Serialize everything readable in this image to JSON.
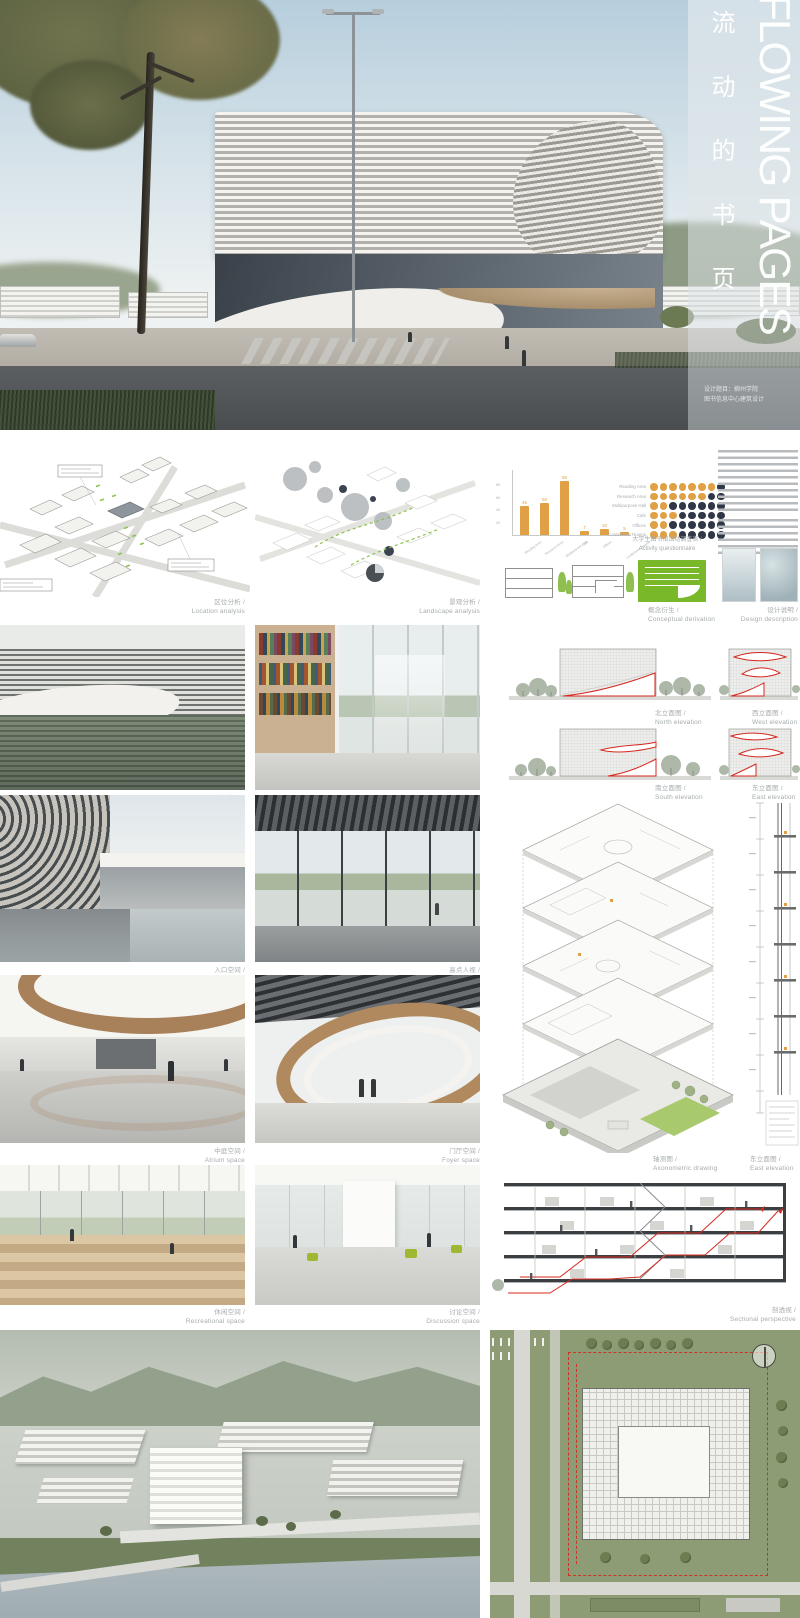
{
  "title": {
    "en_vertical": "FLOWING PAGES",
    "zh_vertical": "流动的书页",
    "credit_line1": "设计题目：柳州学院",
    "credit_line2": "图书信息中心建筑设计"
  },
  "sections": {
    "location_analysis": {
      "zh": "区位分析 /",
      "en": "Location analysis"
    },
    "landscape_analysis": {
      "zh": "景观分析 /",
      "en": "Landscape analysis"
    },
    "questionnaire": {
      "zh": "大学生图书馆活动调查表 /",
      "en": "Activity questionnaire"
    },
    "conceptual_derivation": {
      "zh": "概念衍生 /",
      "en": "Conceptual derivation"
    },
    "design_description": {
      "zh": "设计说明 /",
      "en": "Design description"
    },
    "facade_effect": {
      "zh": "立面效果 /",
      "en": "Facade effect"
    },
    "reading_space": {
      "zh": "阅读空间 /",
      "en": "Reading space"
    },
    "north_elevation": {
      "zh": "北立面图 /",
      "en": "North elevation"
    },
    "west_elevation": {
      "zh": "西立面图 /",
      "en": "West elevation"
    },
    "south_elevation": {
      "zh": "南立面图 /",
      "en": "South elevation"
    },
    "east_elevation": {
      "zh": "东立面图 /",
      "en": "East elevation"
    },
    "entrance_space": {
      "zh": "入口空间 /",
      "en": "Entrance space"
    },
    "high_altitude": {
      "zh": "高点人视 /",
      "en": "High altitude vision"
    },
    "axonometric": {
      "zh": "轴测图 /",
      "en": "Axonometric drawing"
    },
    "east_elevation_detail": {
      "zh": "东立面图 /",
      "en": "East elevation"
    },
    "atrium_space": {
      "zh": "中庭空间 /",
      "en": "Atrium space"
    },
    "foyer_space": {
      "zh": "门厅空间 /",
      "en": "Foyer space"
    },
    "recreational_space": {
      "zh": "休闲空间 /",
      "en": "Recreational space"
    },
    "discussion_space": {
      "zh": "讨论空间 /",
      "en": "Discussion space"
    },
    "sectional_perspective": {
      "zh": "剖透视 /",
      "en": "Sectional perspective"
    }
  },
  "chart_data": {
    "type": "bar",
    "title": "",
    "categories": [
      "Reading Area",
      "Research Area",
      "Multipurpose Hall",
      "Cafe",
      "Offices",
      "Conference Rooms"
    ],
    "values": [
      45,
      50,
      85,
      7,
      10,
      5
    ],
    "yticks": [
      20,
      40,
      60,
      80
    ],
    "ylim": [
      0,
      100
    ],
    "xlabel": "",
    "ylabel": "",
    "bar_color": "#E0A146",
    "grid": false,
    "legend_position": "none"
  },
  "questionnaire": {
    "areas": [
      "Reading Area",
      "Research Area",
      "Multipurpose Hall",
      "Cafe",
      "Offices",
      "Conference Rooms"
    ],
    "columns": 8,
    "filled": [
      7,
      6,
      2,
      3,
      2,
      3
    ],
    "filled_color": "#E0A146",
    "empty_color": "#303848"
  },
  "colors": {
    "accent_orange": "#E0A146",
    "navy": "#303848",
    "concept_green": "#79B829",
    "elevation_red": "#D42A20",
    "caption_gray": "#A6ABAE"
  }
}
